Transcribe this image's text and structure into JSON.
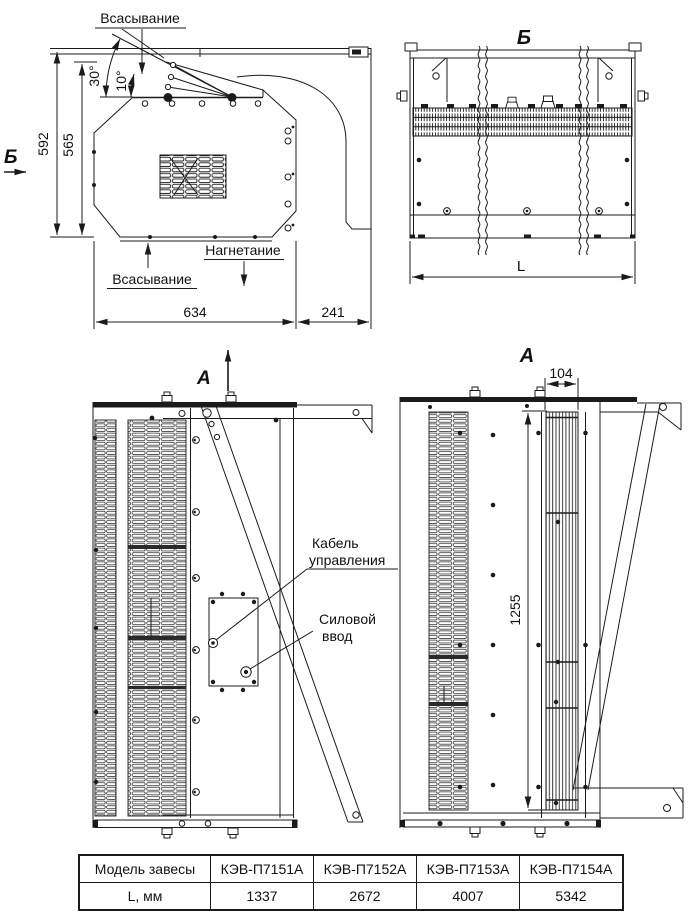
{
  "drawing": {
    "side_view": {
      "marker": "Б",
      "suction_top": "Всасывание",
      "suction_bottom": "Всасывание",
      "discharge": "Нагнетание",
      "angle_outer": "30°",
      "angle_inner": "10°",
      "dim_total_height": "592",
      "dim_body_height": "565",
      "dim_body_width": "634",
      "dim_bracket_width": "241"
    },
    "section_marker": "А",
    "view_b": {
      "title": "Б",
      "dim_length": "L"
    },
    "front_view": {
      "control_cable_line1": "Кабель",
      "control_cable_line2": "управления",
      "power_inlet_line1": "Силовой",
      "power_inlet_line2": "ввод"
    },
    "view_a": {
      "title": "А",
      "dim_nozzle_width": "104",
      "dim_nozzle_length": "1255"
    }
  },
  "table": {
    "headers": [
      "Модель завесы",
      "КЭВ-П7151А",
      "КЭВ-П7152А",
      "КЭВ-П7153А",
      "КЭВ-П7154А"
    ],
    "row_label": "L, мм",
    "row_values": [
      "1337",
      "2672",
      "4007",
      "5342"
    ]
  },
  "colors": {
    "line": "#1b1b1b",
    "text": "#111111",
    "background": "#ffffff"
  }
}
